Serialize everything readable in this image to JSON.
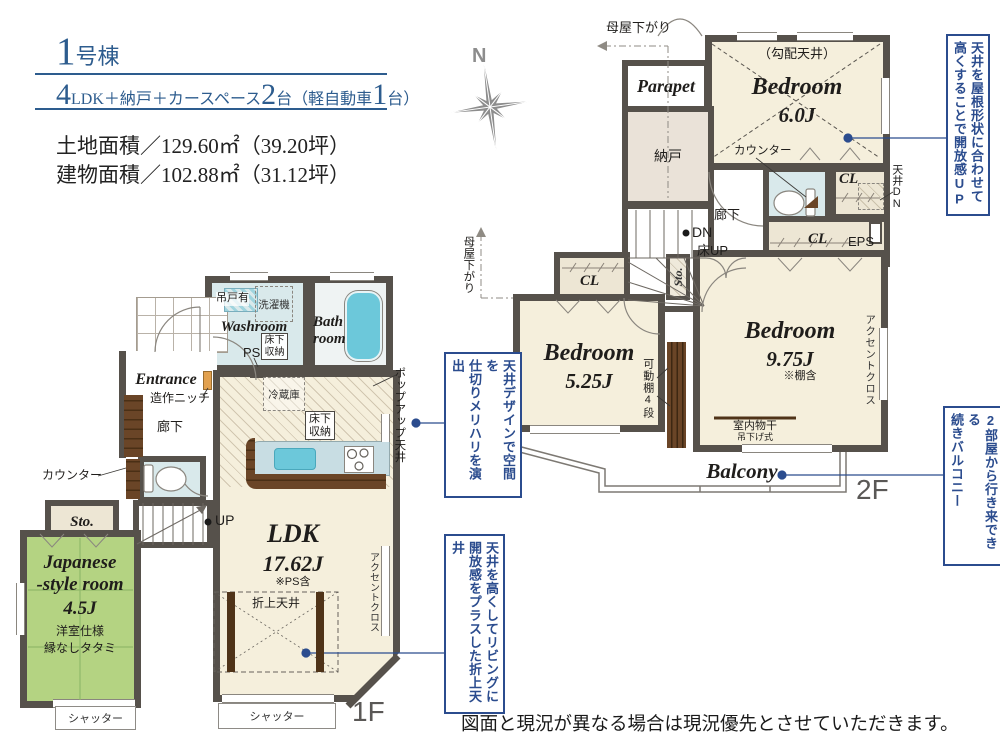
{
  "header": {
    "building_num": "1",
    "building_suffix": "号棟",
    "spec": {
      "n1": "4",
      "t1": "LDK＋納戸＋カースペース",
      "n2": "2",
      "t2": "台（軽自動車",
      "n3": "1",
      "t3": "台）"
    },
    "land_area": "土地面積／129.60㎡（39.20坪）",
    "building_area": "建物面積／102.88㎡（31.12坪）"
  },
  "compass": {
    "north": "N"
  },
  "notes": {
    "roof": {
      "c1": "天井を屋根形状に合わせて",
      "c2": "高くすることで開放感UP"
    },
    "balcony": {
      "c1": "2部屋から行き来できる",
      "c2": "続きバルコニー"
    },
    "kitchen": {
      "c1": "天井デザインで空間を",
      "c2": "仕切りメリハリを演出"
    },
    "living": {
      "c1": "天井を高くしてリビングに",
      "c2": "開放感をプラスした折上天井"
    }
  },
  "f2": {
    "floor_label": "2F",
    "moya_top": "母屋下がり",
    "moya_left": "母屋下がり",
    "parapet": "Parapet",
    "nando": "納戸",
    "bedroom6": {
      "name": "Bedroom",
      "size": "6.0J",
      "note": "（勾配天井）"
    },
    "counter": "カウンター",
    "cl": "CL",
    "tenjo_dn": "天井DN",
    "eps": "EPS",
    "hall": "廊下",
    "dn": "DN",
    "yuka_up": "床UP",
    "sto": "Sto.",
    "bedroom525": {
      "name": "Bedroom",
      "size": "5.25J"
    },
    "kadou": "可動棚4段",
    "bedroom975": {
      "name": "Bedroom",
      "size": "9.75J",
      "note": "※棚含"
    },
    "accent": "アクセントクロス",
    "monohoshi": "室内物干",
    "tsurisage": "吊下げ式",
    "balcony": "Balcony"
  },
  "f1": {
    "floor_label": "1F",
    "tsurido": "吊戸有",
    "sentaku": "洗濯機",
    "washroom": "Washroom",
    "ps": "PS",
    "yukashita": "床下収納",
    "bath1": "Bath",
    "bath2": "room",
    "entrance": "Entrance",
    "niche": "造作ニッチ",
    "hall": "廊下",
    "counter": "カウンター",
    "sto": "Sto.",
    "up": "UP",
    "jroom": {
      "n1": "Japanese",
      "n2": "-style room",
      "size": "4.5J",
      "note1": "洋室仕様",
      "note2": "縁なしタタミ"
    },
    "shutter": "シャッター",
    "reizouko": "冷蔵庫",
    "ldk": {
      "name": "LDK",
      "size": "17.62J",
      "note": "※PS含"
    },
    "oriage": "折上天井",
    "accent": "アクセントクロス",
    "popup": "ポップアップ天井"
  },
  "footer": "図面と現況が異なる場合は現況優先とさせていただきます。",
  "colors": {
    "accent_blue": "#2b4c8e",
    "heading_blue": "#2d5c8e",
    "wall_gray": "#56514b",
    "floor_cream": "#f5efdc",
    "tatami_green": "#b4d382",
    "water_blue": "#d9e9eb",
    "tub_blue": "#6cc8da",
    "wood_brown": "#6a4527",
    "floor_label_gray": "#5a5856",
    "compass_gray": "#8d8d8d"
  }
}
